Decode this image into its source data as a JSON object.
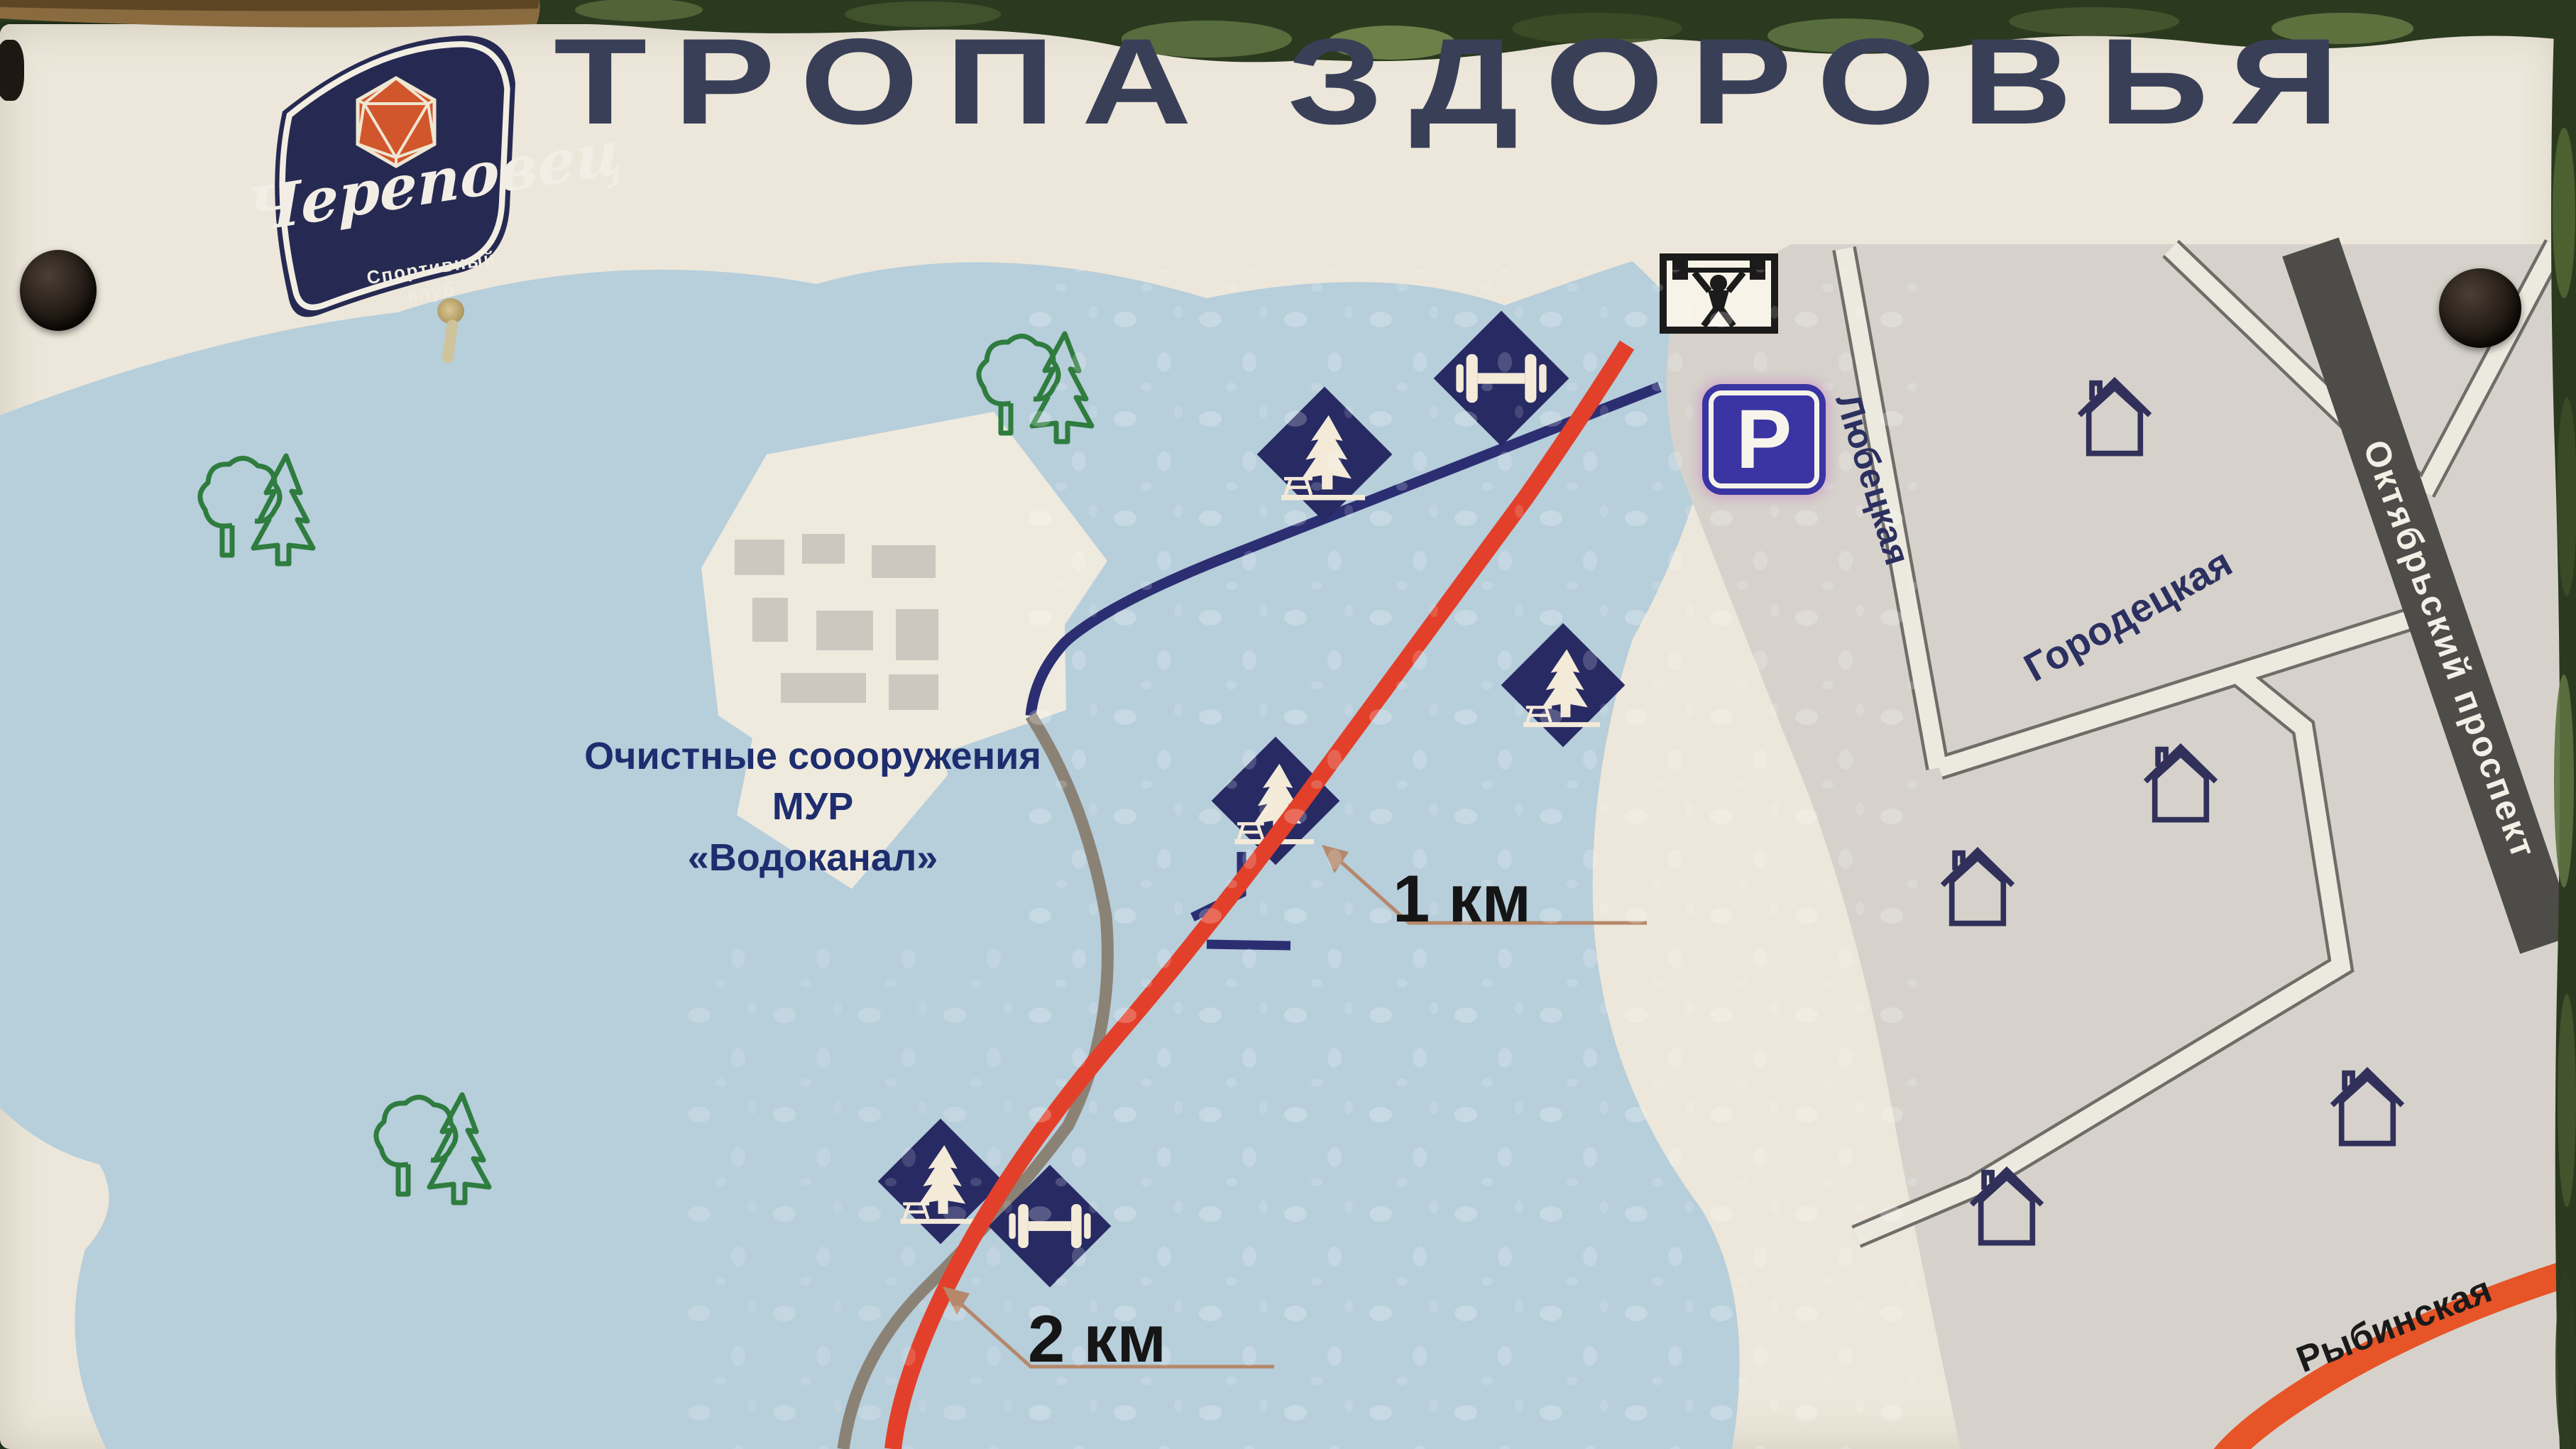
{
  "sign": {
    "title": "ТРОПА ЗДОРОВЬЯ",
    "logo": {
      "club_name": "Череповец",
      "subtitle_line1": "Спортивный",
      "subtitle_line2": "клуб"
    },
    "map": {
      "facility_line1": "Очистные соооружения",
      "facility_line2": "МУР",
      "facility_line3": "«Водоканал»",
      "marker_1km": "1 км",
      "marker_2km": "2 км",
      "parking_letter": "P",
      "street_lyubetskaya": "Любецкая",
      "street_gorodetskaya": "Городецкая",
      "street_oktyabrsky": "Октябрьский проспект",
      "street_rybinskaya": "Рыбинская"
    },
    "icons": {
      "trail_markers": [
        "fir-tree-picnic-marker-icon",
        "dumbbell-marker-icon"
      ],
      "pictograms": [
        "weightlifter-icon",
        "parking-icon",
        "house-icon",
        "tree-pair-icon"
      ]
    },
    "colors": {
      "board_cream": "#ece7da",
      "park_blue": "#b7cedb",
      "city_gray": "#d6d2cb",
      "marker_navy": "#272a63",
      "trail_red": "#e2402a",
      "trail_navy": "#2c2e72",
      "path_gray": "#8b8276",
      "road_dark": "#4d4c48",
      "road_orange": "#e65427",
      "tree_green": "#2f7c3f",
      "parking_blue": "#3a35a3",
      "title_navy": "#3a3f58"
    }
  }
}
